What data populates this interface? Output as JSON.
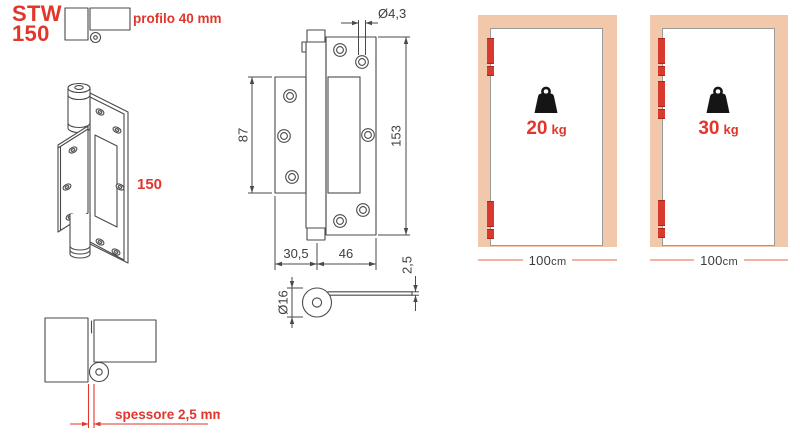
{
  "header": {
    "product_code": "STW",
    "product_size": "150",
    "profile_label": "profilo 40 mm"
  },
  "hinge_3d": {
    "length_label": "150"
  },
  "front_view": {
    "hole_diameter": "Ø4,3",
    "leaf_height": "87",
    "total_height": "153",
    "offset_width": "30,5",
    "leaf_width": "46"
  },
  "side_view": {
    "knuckle_diameter": "Ø16",
    "leaf_thickness": "2,5"
  },
  "section_view": {
    "thickness_label": "spessore 2,5 mm"
  },
  "doors": [
    {
      "hinges": 2,
      "capacity_value": "20",
      "capacity_unit": "kg",
      "width_value": "100",
      "width_unit": "cm"
    },
    {
      "hinges": 3,
      "capacity_value": "30",
      "capacity_unit": "kg",
      "width_value": "100",
      "width_unit": "cm"
    }
  ],
  "colors": {
    "accent_red": "#e2352b",
    "hinge_red": "#d93a2f",
    "frame_tan": "#f1c8a9",
    "measure_line_salmon": "#f3b3a2",
    "drawing_stroke": "#4a4a4a",
    "dim_text": "#3e3e3e",
    "door_border": "#9b9b9b",
    "weight_black": "#151515"
  }
}
